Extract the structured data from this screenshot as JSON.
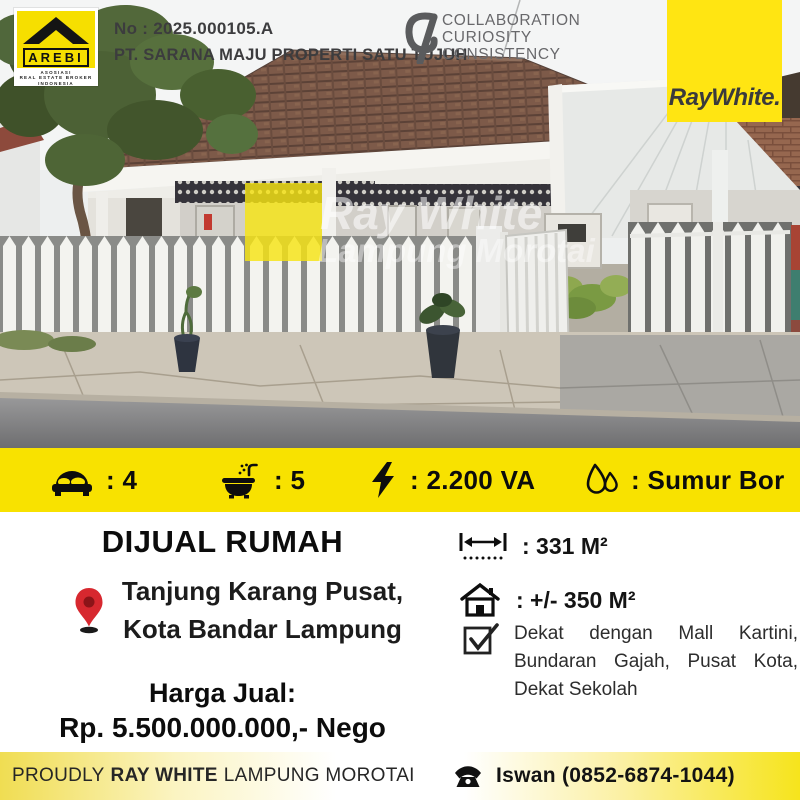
{
  "header": {
    "listing_no": "No : 2025.000105.A",
    "company": "PT. SARANA MAJU PROPERTI SATU TUJUH",
    "arebi_logo": {
      "name": "AREBI",
      "line1": "ASOSIASI",
      "line2": "REAL ESTATE BROKER",
      "line3": "INDONESIA"
    },
    "values_logo": {
      "line1": "COLLABORATION",
      "line2": "CURIOSITY",
      "line3": "CONSISTENCY"
    },
    "brand_logo": {
      "text": "RayWhite.",
      "bg_color": "#FFE512"
    }
  },
  "photo": {
    "watermark_line1": "Ray White",
    "watermark_line2": "Lampung Morotai"
  },
  "amenities": {
    "bg_color": "#F8E200",
    "items": [
      {
        "icon": "bed-icon",
        "value": ": 4"
      },
      {
        "icon": "bath-icon",
        "value": ": 5"
      },
      {
        "icon": "electricity-icon",
        "value": ": 2.200 VA"
      },
      {
        "icon": "water-drop-icon",
        "value": ": Sumur Bor"
      }
    ]
  },
  "details": {
    "title": "DIJUAL RUMAH",
    "location": {
      "icon": "map-pin-icon",
      "line1": "Tanjung Karang Pusat,",
      "line2": "Kota Bandar Lampung"
    },
    "price": {
      "label": "Harga Jual:",
      "value": "Rp. 5.500.000.000,- Nego"
    },
    "land": {
      "icon": "land-width-icon",
      "value": ": 331 M²"
    },
    "building": {
      "icon": "house-icon",
      "value": ": +/- 350 M²"
    },
    "nearby": {
      "icon": "checkbox-icon",
      "text": "Dekat dengan Mall Kartini, Bundaran Gajah, Pusat Kota, Dekat Sekolah"
    }
  },
  "footer": {
    "proudly": "PROUDLY",
    "brand": "RAY WHITE",
    "office": "LAMPUNG MOROTAI",
    "agent": "Iswan (0852-6874-1044)"
  }
}
